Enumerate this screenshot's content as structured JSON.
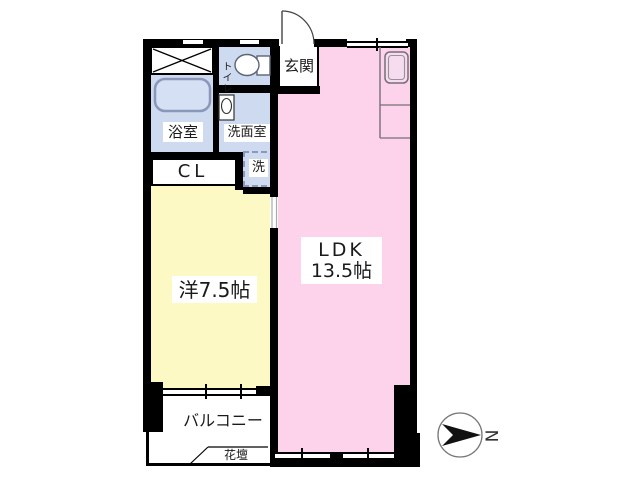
{
  "rooms": {
    "ldk": {
      "name_line": "LDK",
      "size_line": "13.5帖"
    },
    "western": {
      "label": "洋7.5帖"
    },
    "bathroom": {
      "label": "浴室"
    },
    "toilet": {
      "label": "トイレ"
    },
    "washroom": {
      "label": "洗面室"
    },
    "laundry": {
      "label": "洗"
    },
    "closet": {
      "label": "CL"
    },
    "entrance": {
      "label": "玄関"
    },
    "balcony": {
      "label": "バルコニー"
    },
    "flowerbed": {
      "label": "花壇"
    }
  },
  "compass": {
    "letter": "N"
  },
  "colors": {
    "ldk_pink": "#fdd3eb",
    "western_yellow": "#fcf9c5",
    "wet_area_blue": "#cedaf0",
    "wall_black": "#000000"
  }
}
